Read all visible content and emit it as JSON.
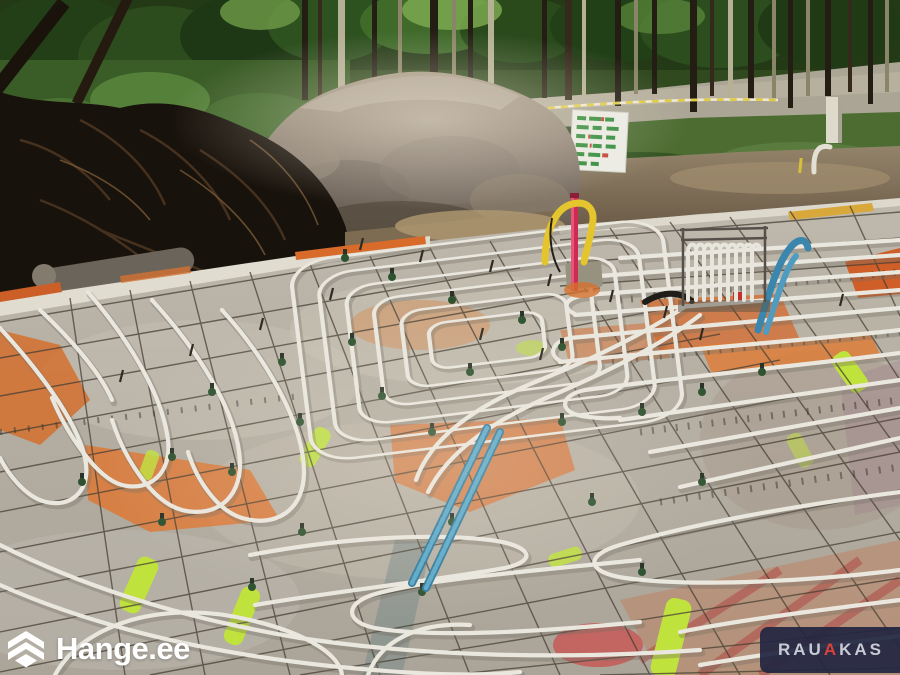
{
  "watermarks": {
    "hange": {
      "text": "Hange.ee",
      "icon": "hange-cube-logo",
      "color": "#ffffff"
    },
    "rauakas": {
      "part1": "RAU",
      "part2": "A",
      "part3": "KAS",
      "bg_color": "#232642",
      "text_color": "#c8cbd5",
      "accent_color": "#d8423a"
    }
  },
  "scene": {
    "type": "construction-site-photo",
    "subject": "Underfloor heating pipes and steel rebar mesh laid on a foundation slab",
    "background": "Forest, excavated soil piles, gravel road with caution tape",
    "notable_colors": {
      "heating_pipe": "#eae7df",
      "rebar_mesh": "#4a4238",
      "insulation_orange": "#dd7030",
      "marking_lime": "#bfe23c",
      "supply_pipe_blue": "#3e8cb2",
      "riser_red": "#cf2b52",
      "riser_yellow": "#e5c52e"
    }
  }
}
